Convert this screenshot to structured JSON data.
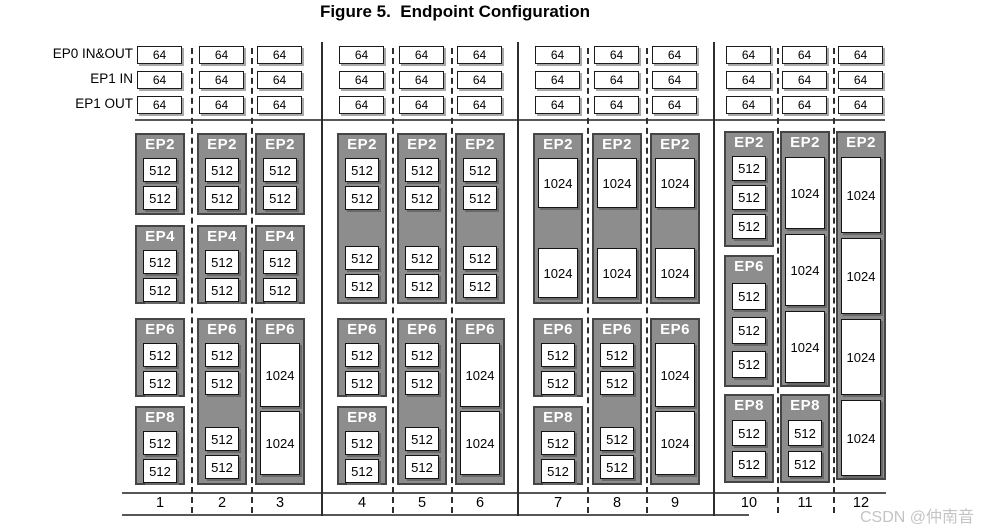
{
  "title": "Figure 5.  Endpoint Configuration",
  "watermark": "CSDN @仲南音",
  "header_rows": [
    {
      "label": "EP0 IN&OUT",
      "value": "64"
    },
    {
      "label": "EP1 IN",
      "value": "64"
    },
    {
      "label": "EP1 OUT",
      "value": "64"
    }
  ],
  "colors": {
    "block_fill": "#8d8d8d",
    "block_border": "#454545",
    "buffer_fill": "#ffffff",
    "line": "#2e2e2e",
    "watermark": "#c4c4c4"
  },
  "columns": [
    {
      "number": "1",
      "blocks": [
        {
          "label": "EP2",
          "top": 133,
          "height": 82,
          "items": [
            {
              "type": "buffer",
              "value": "512",
              "h": 24
            },
            {
              "type": "buffer",
              "value": "512",
              "h": 24
            }
          ]
        },
        {
          "label": "EP4",
          "top": 225,
          "height": 79,
          "items": [
            {
              "type": "buffer",
              "value": "512",
              "h": 24
            },
            {
              "type": "buffer",
              "value": "512",
              "h": 24
            }
          ]
        },
        {
          "label": "EP6",
          "top": 318,
          "height": 79,
          "items": [
            {
              "type": "buffer",
              "value": "512",
              "h": 24
            },
            {
              "type": "buffer",
              "value": "512",
              "h": 24
            }
          ]
        },
        {
          "label": "EP8",
          "top": 406,
          "height": 79,
          "items": [
            {
              "type": "buffer",
              "value": "512",
              "h": 24
            },
            {
              "type": "buffer",
              "value": "512",
              "h": 24
            }
          ]
        }
      ]
    },
    {
      "number": "2",
      "blocks": [
        {
          "label": "EP2",
          "top": 133,
          "height": 82,
          "items": [
            {
              "type": "buffer",
              "value": "512",
              "h": 24
            },
            {
              "type": "buffer",
              "value": "512",
              "h": 24
            }
          ]
        },
        {
          "label": "EP4",
          "top": 225,
          "height": 79,
          "items": [
            {
              "type": "buffer",
              "value": "512",
              "h": 24
            },
            {
              "type": "buffer",
              "value": "512",
              "h": 24
            }
          ]
        },
        {
          "label": "EP6",
          "top": 318,
          "height": 167,
          "items": [
            {
              "type": "buffer",
              "value": "512",
              "h": 24
            },
            {
              "type": "buffer",
              "value": "512",
              "h": 24
            },
            {
              "type": "spacer"
            },
            {
              "type": "buffer",
              "value": "512",
              "h": 24
            },
            {
              "type": "buffer",
              "value": "512",
              "h": 24
            }
          ]
        }
      ]
    },
    {
      "number": "3",
      "blocks": [
        {
          "label": "EP2",
          "top": 133,
          "height": 82,
          "items": [
            {
              "type": "buffer",
              "value": "512",
              "h": 24
            },
            {
              "type": "buffer",
              "value": "512",
              "h": 24
            }
          ]
        },
        {
          "label": "EP4",
          "top": 225,
          "height": 79,
          "items": [
            {
              "type": "buffer",
              "value": "512",
              "h": 24
            },
            {
              "type": "buffer",
              "value": "512",
              "h": 24
            }
          ]
        },
        {
          "label": "EP6",
          "top": 318,
          "height": 167,
          "items": [
            {
              "type": "buffer",
              "value": "1024",
              "h": 64
            },
            {
              "type": "buffer",
              "value": "1024",
              "h": 64
            }
          ]
        }
      ]
    },
    {
      "number": "4",
      "blocks": [
        {
          "label": "EP2",
          "top": 133,
          "height": 171,
          "items": [
            {
              "type": "buffer",
              "value": "512",
              "h": 24
            },
            {
              "type": "buffer",
              "value": "512",
              "h": 24
            },
            {
              "type": "spacer"
            },
            {
              "type": "buffer",
              "value": "512",
              "h": 24
            },
            {
              "type": "buffer",
              "value": "512",
              "h": 24
            }
          ]
        },
        {
          "label": "EP6",
          "top": 318,
          "height": 79,
          "items": [
            {
              "type": "buffer",
              "value": "512",
              "h": 24
            },
            {
              "type": "buffer",
              "value": "512",
              "h": 24
            }
          ]
        },
        {
          "label": "EP8",
          "top": 406,
          "height": 79,
          "items": [
            {
              "type": "buffer",
              "value": "512",
              "h": 24
            },
            {
              "type": "buffer",
              "value": "512",
              "h": 24
            }
          ]
        }
      ]
    },
    {
      "number": "5",
      "blocks": [
        {
          "label": "EP2",
          "top": 133,
          "height": 171,
          "items": [
            {
              "type": "buffer",
              "value": "512",
              "h": 24
            },
            {
              "type": "buffer",
              "value": "512",
              "h": 24
            },
            {
              "type": "spacer"
            },
            {
              "type": "buffer",
              "value": "512",
              "h": 24
            },
            {
              "type": "buffer",
              "value": "512",
              "h": 24
            }
          ]
        },
        {
          "label": "EP6",
          "top": 318,
          "height": 167,
          "items": [
            {
              "type": "buffer",
              "value": "512",
              "h": 24
            },
            {
              "type": "buffer",
              "value": "512",
              "h": 24
            },
            {
              "type": "spacer"
            },
            {
              "type": "buffer",
              "value": "512",
              "h": 24
            },
            {
              "type": "buffer",
              "value": "512",
              "h": 24
            }
          ]
        }
      ]
    },
    {
      "number": "6",
      "blocks": [
        {
          "label": "EP2",
          "top": 133,
          "height": 171,
          "items": [
            {
              "type": "buffer",
              "value": "512",
              "h": 24
            },
            {
              "type": "buffer",
              "value": "512",
              "h": 24
            },
            {
              "type": "spacer"
            },
            {
              "type": "buffer",
              "value": "512",
              "h": 24
            },
            {
              "type": "buffer",
              "value": "512",
              "h": 24
            }
          ]
        },
        {
          "label": "EP6",
          "top": 318,
          "height": 167,
          "items": [
            {
              "type": "buffer",
              "value": "1024",
              "h": 64
            },
            {
              "type": "buffer",
              "value": "1024",
              "h": 64
            }
          ]
        }
      ]
    },
    {
      "number": "7",
      "blocks": [
        {
          "label": "EP2",
          "top": 133,
          "height": 171,
          "items": [
            {
              "type": "buffer",
              "value": "1024",
              "h": 50
            },
            {
              "type": "spacer"
            },
            {
              "type": "buffer",
              "value": "1024",
              "h": 50
            }
          ]
        },
        {
          "label": "EP6",
          "top": 318,
          "height": 79,
          "items": [
            {
              "type": "buffer",
              "value": "512",
              "h": 24
            },
            {
              "type": "buffer",
              "value": "512",
              "h": 24
            }
          ]
        },
        {
          "label": "EP8",
          "top": 406,
          "height": 79,
          "items": [
            {
              "type": "buffer",
              "value": "512",
              "h": 24
            },
            {
              "type": "buffer",
              "value": "512",
              "h": 24
            }
          ]
        }
      ]
    },
    {
      "number": "8",
      "blocks": [
        {
          "label": "EP2",
          "top": 133,
          "height": 171,
          "items": [
            {
              "type": "buffer",
              "value": "1024",
              "h": 50
            },
            {
              "type": "spacer"
            },
            {
              "type": "buffer",
              "value": "1024",
              "h": 50
            }
          ]
        },
        {
          "label": "EP6",
          "top": 318,
          "height": 167,
          "items": [
            {
              "type": "buffer",
              "value": "512",
              "h": 24
            },
            {
              "type": "buffer",
              "value": "512",
              "h": 24
            },
            {
              "type": "spacer"
            },
            {
              "type": "buffer",
              "value": "512",
              "h": 24
            },
            {
              "type": "buffer",
              "value": "512",
              "h": 24
            }
          ]
        }
      ]
    },
    {
      "number": "9",
      "blocks": [
        {
          "label": "EP2",
          "top": 133,
          "height": 171,
          "items": [
            {
              "type": "buffer",
              "value": "1024",
              "h": 50
            },
            {
              "type": "spacer"
            },
            {
              "type": "buffer",
              "value": "1024",
              "h": 50
            }
          ]
        },
        {
          "label": "EP6",
          "top": 318,
          "height": 167,
          "items": [
            {
              "type": "buffer",
              "value": "1024",
              "h": 64
            },
            {
              "type": "buffer",
              "value": "1024",
              "h": 64
            }
          ]
        }
      ]
    },
    {
      "number": "10",
      "blocks": [
        {
          "label": "EP2",
          "top": 131,
          "height": 116,
          "gap": 4,
          "items": [
            {
              "type": "buffer",
              "value": "512",
              "h": 25
            },
            {
              "type": "buffer",
              "value": "512",
              "h": 25
            },
            {
              "type": "buffer",
              "value": "512",
              "h": 25
            }
          ]
        },
        {
          "label": "EP6",
          "top": 255,
          "height": 132,
          "gap": 7,
          "items": [
            {
              "type": "buffer",
              "value": "512",
              "h": 27
            },
            {
              "type": "buffer",
              "value": "512",
              "h": 27
            },
            {
              "type": "buffer",
              "value": "512",
              "h": 27
            }
          ]
        },
        {
          "label": "EP8",
          "top": 394,
          "height": 89,
          "gap": 5,
          "items": [
            {
              "type": "buffer",
              "value": "512",
              "h": 26
            },
            {
              "type": "buffer",
              "value": "512",
              "h": 26
            }
          ]
        }
      ]
    },
    {
      "number": "11",
      "blocks": [
        {
          "label": "EP2",
          "top": 131,
          "height": 256,
          "gap": 5,
          "items": [
            {
              "type": "buffer",
              "value": "1024",
              "h": 72
            },
            {
              "type": "buffer",
              "value": "1024",
              "h": 72
            },
            {
              "type": "buffer",
              "value": "1024",
              "h": 72
            }
          ]
        },
        {
          "label": "EP8",
          "top": 394,
          "height": 89,
          "gap": 5,
          "items": [
            {
              "type": "buffer",
              "value": "512",
              "h": 26
            },
            {
              "type": "buffer",
              "value": "512",
              "h": 26
            }
          ]
        }
      ]
    },
    {
      "number": "12",
      "blocks": [
        {
          "label": "EP2",
          "top": 131,
          "height": 349,
          "gap": 5,
          "items": [
            {
              "type": "buffer",
              "value": "1024",
              "h": 76
            },
            {
              "type": "buffer",
              "value": "1024",
              "h": 76
            },
            {
              "type": "buffer",
              "value": "1024",
              "h": 76
            },
            {
              "type": "buffer",
              "value": "1024",
              "h": 76
            }
          ]
        }
      ]
    }
  ]
}
